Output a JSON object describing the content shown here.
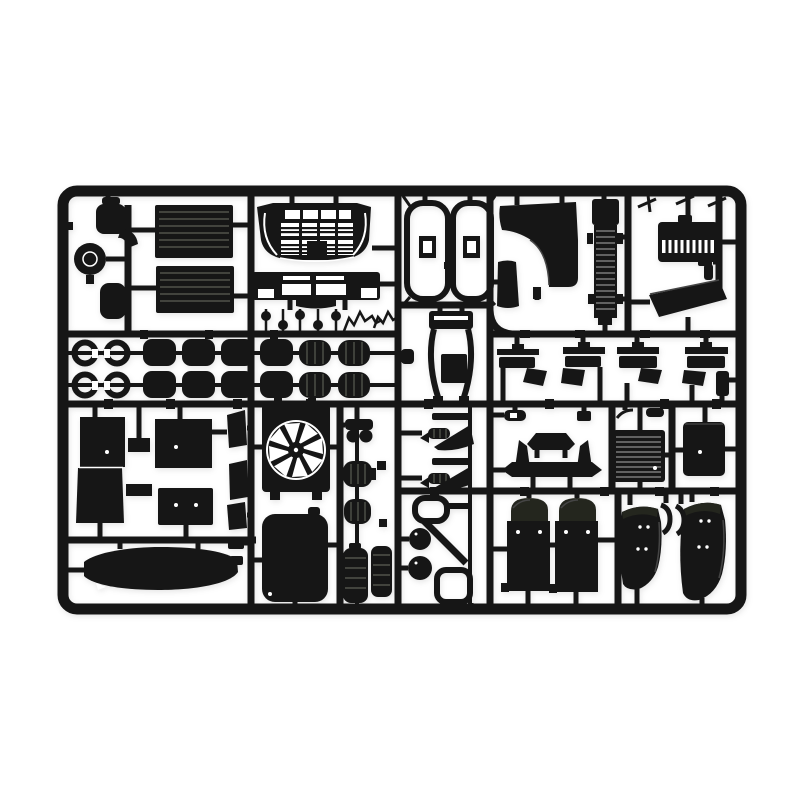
{
  "scene": {
    "description": "Product photo of a black injection-molded plastic model kit sprue (truck parts frame) on a plain white background",
    "background_color": "#ffffff",
    "plastic_color": "#161616",
    "plastic_tint": "#24261e",
    "rib_color": "#50524a",
    "rib_color_light": "#7a7a7a",
    "highlight_color": "#454545"
  },
  "sprue": {
    "frame": {
      "x": 63,
      "y": 191,
      "width": 678,
      "height": 418,
      "corner_radius": 14,
      "thickness": 11
    },
    "parts": [
      {
        "name": "air-canister",
        "qty": 2
      },
      {
        "name": "filler-knob",
        "qty": 1
      },
      {
        "name": "pipe-elbow",
        "qty": 1
      },
      {
        "name": "side-deflector-panel",
        "qty": 2
      },
      {
        "name": "truck-grille",
        "qty": 1
      },
      {
        "name": "front-bumper",
        "qty": 1
      },
      {
        "name": "mirror-pin",
        "qty": 5
      },
      {
        "name": "twig-bracket",
        "qty": 2
      },
      {
        "name": "clamp-ring",
        "qty": 4
      },
      {
        "name": "cab-mount-bushing",
        "qty": 8
      },
      {
        "name": "ribbed-coupler",
        "qty": 4
      },
      {
        "name": "chassis-wishbone",
        "qty": 2
      },
      {
        "name": "seat-frame",
        "qty": 1
      },
      {
        "name": "cab-corner-panel",
        "qty": 1
      },
      {
        "name": "side-slab",
        "qty": 1
      },
      {
        "name": "radiator-ladder",
        "qty": 1
      },
      {
        "name": "engine-cover",
        "qty": 1
      },
      {
        "name": "roof-deflector",
        "qty": 1
      },
      {
        "name": "sprue-dart",
        "qty": 3
      },
      {
        "name": "step-bracket",
        "qty": 4
      },
      {
        "name": "door-panel",
        "qty": 2
      },
      {
        "name": "blank-panel",
        "qty": 1
      },
      {
        "name": "battery-box",
        "qty": 1
      },
      {
        "name": "side-flap",
        "qty": 3
      },
      {
        "name": "fan-shroud",
        "qty": 1
      },
      {
        "name": "fuel-tank",
        "qty": 1
      },
      {
        "name": "sun-visor",
        "qty": 1
      },
      {
        "name": "twin-horn-bracket",
        "qty": 1
      },
      {
        "name": "air-filter",
        "qty": 2
      },
      {
        "name": "air-tank",
        "qty": 2
      },
      {
        "name": "leaf-spring",
        "qty": 2
      },
      {
        "name": "lamp-bracket-frame",
        "qty": 1
      },
      {
        "name": "fog-lamp",
        "qty": 2
      },
      {
        "name": "stabilizer-bar",
        "qty": 1
      },
      {
        "name": "radiator-core",
        "qty": 1
      },
      {
        "name": "oil-cooler",
        "qty": 1
      },
      {
        "name": "front-mudguard",
        "qty": 2
      },
      {
        "name": "rear-fender",
        "qty": 2
      },
      {
        "name": "fender-liner-hook",
        "qty": 2
      }
    ]
  }
}
